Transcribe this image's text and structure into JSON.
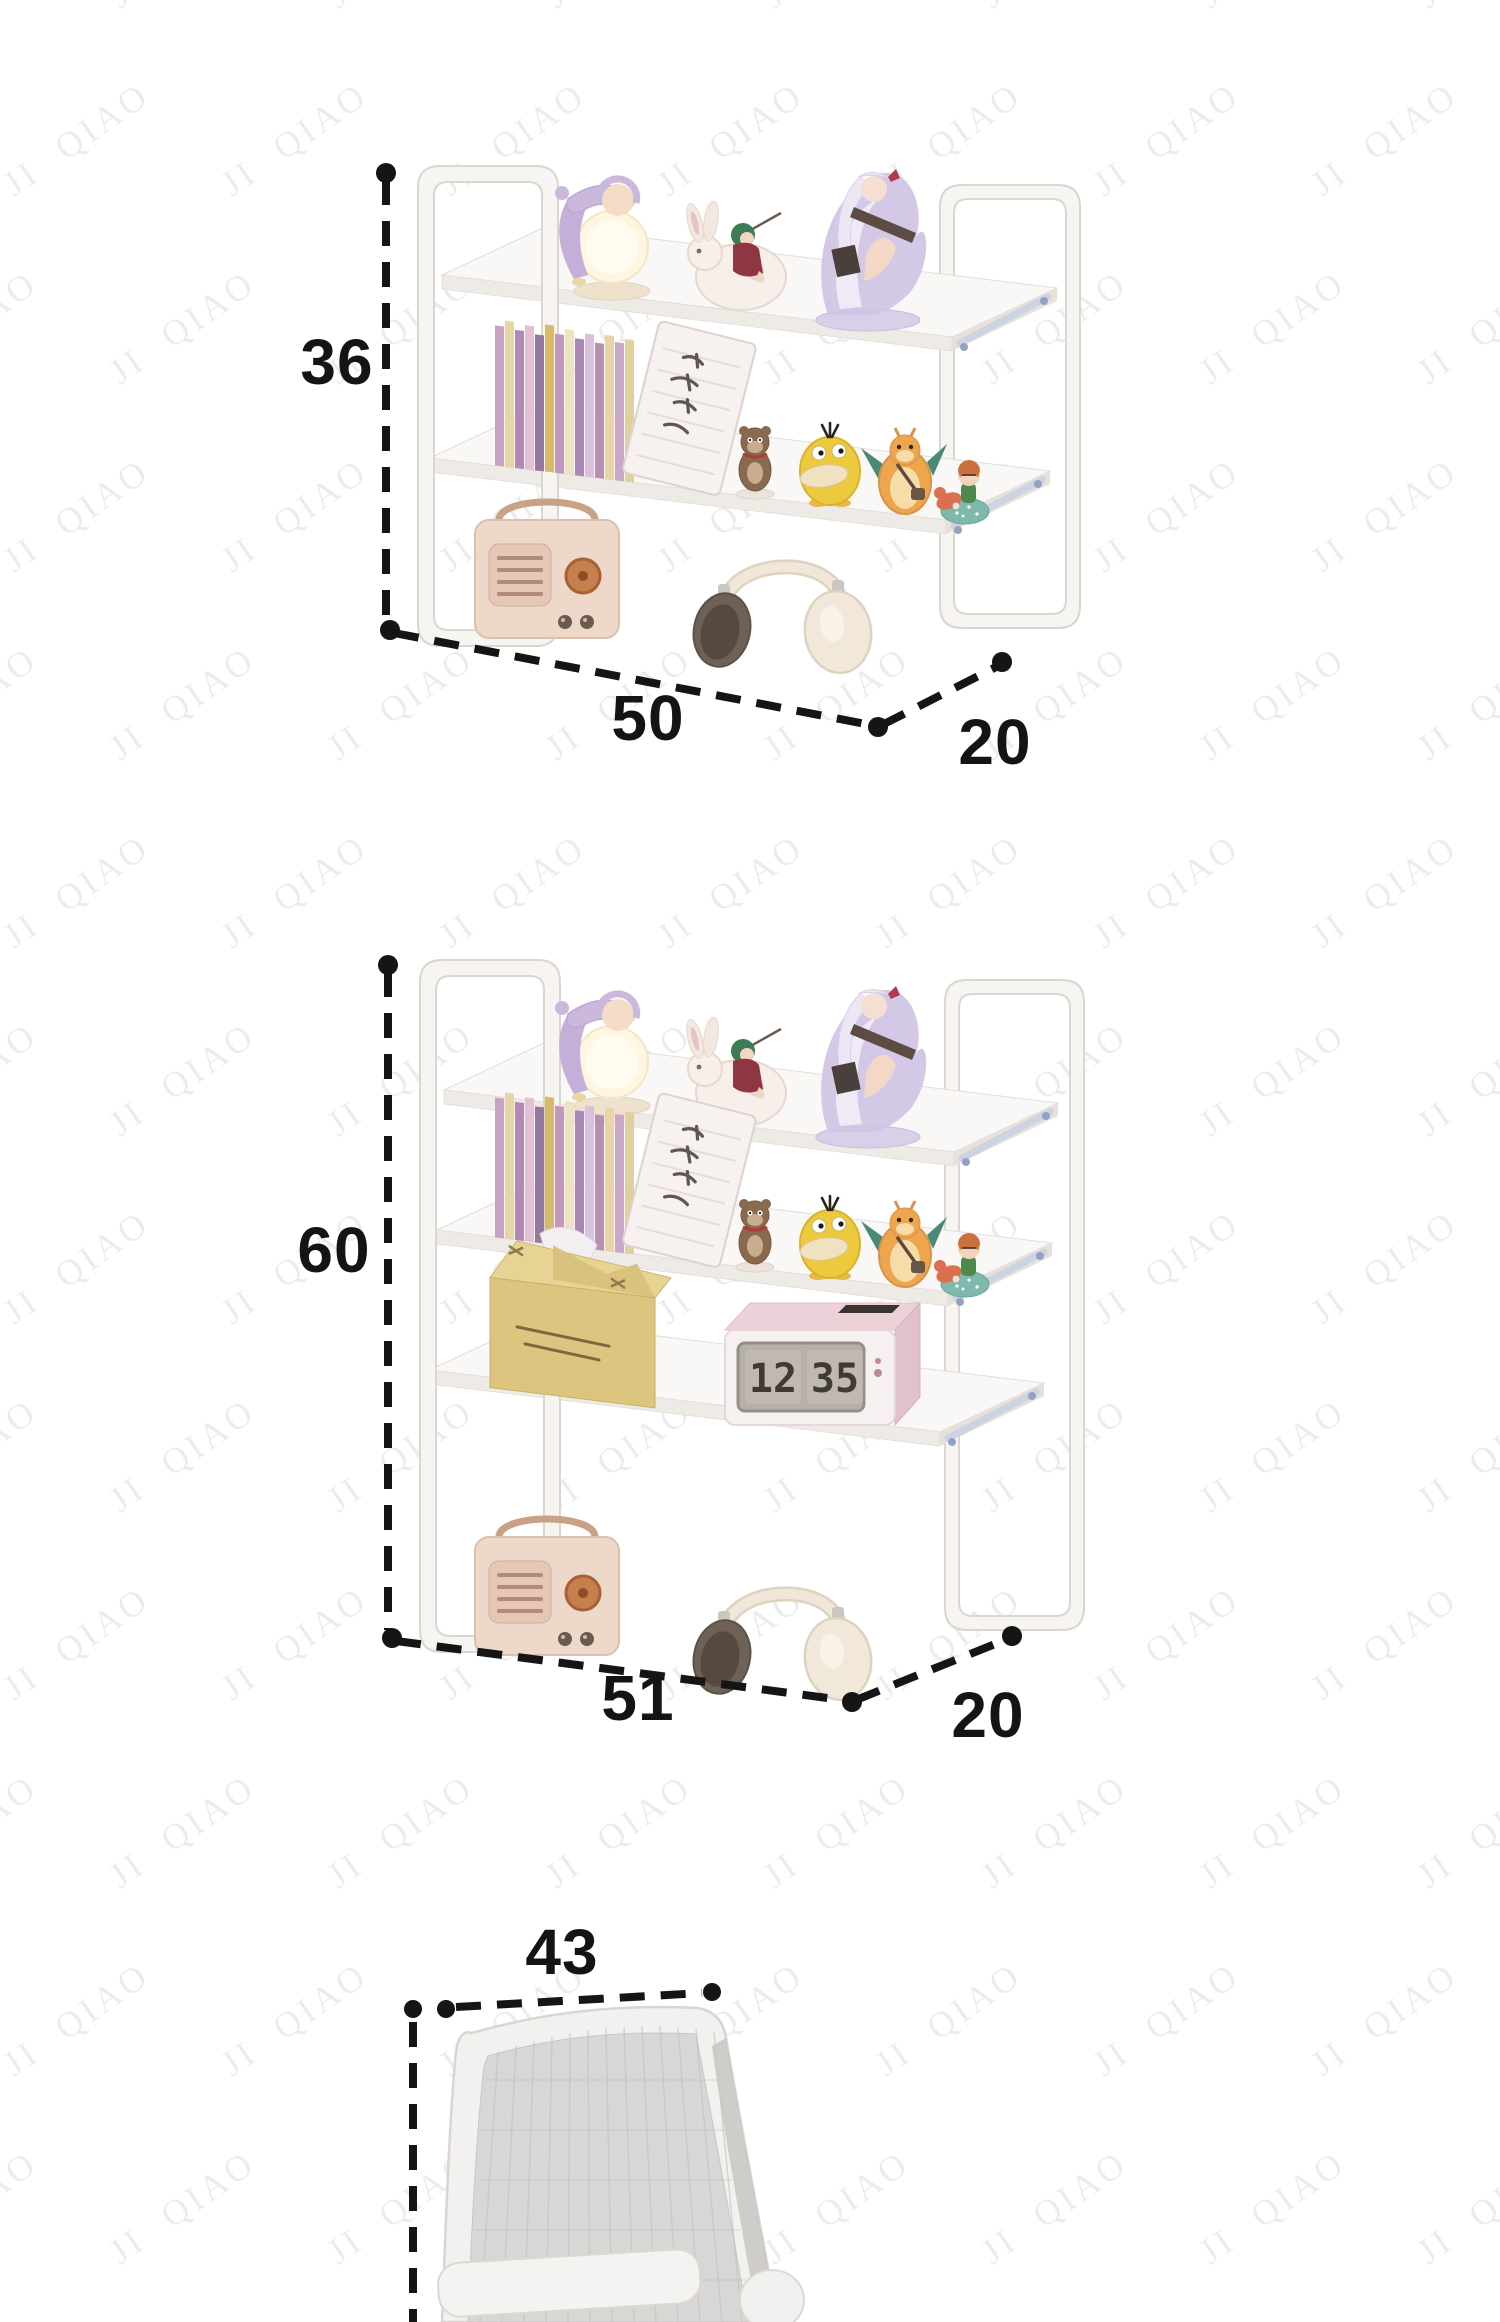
{
  "page": {
    "background": "#ffffff",
    "kind": "product-dimension-image"
  },
  "watermark": {
    "text": "JI QIAO",
    "color": "rgba(0,0,0,0.075)"
  },
  "dimension_style": {
    "line_color": "#151515",
    "label_color": "#141414"
  },
  "products": [
    {
      "id": "shelf-2-tier",
      "height": "36",
      "width": "50",
      "depth": "20"
    },
    {
      "id": "shelf-3-tier",
      "height": "60",
      "width": "51",
      "depth": "20"
    },
    {
      "id": "chair-backrest",
      "width": "43"
    }
  ],
  "clock": {
    "hours": "12",
    "minutes": "35"
  }
}
